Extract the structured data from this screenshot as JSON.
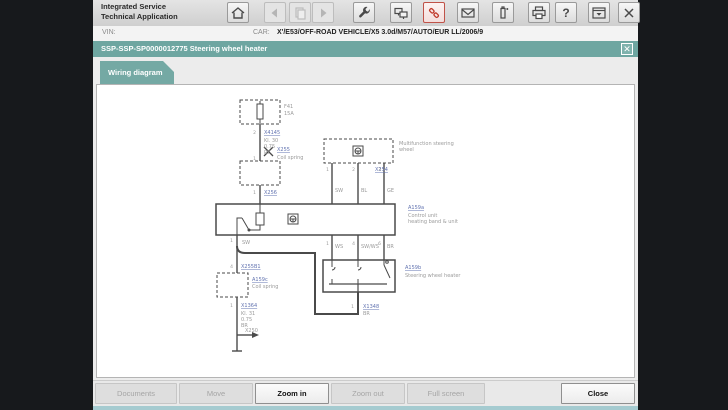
{
  "window": {
    "title_line1": "Integrated Service",
    "title_line2": "Technical Application"
  },
  "toolbar": {
    "icons": [
      "home",
      "back",
      "document",
      "forward",
      "workshop-tools",
      "terminal-mode",
      "vehicle-connection",
      "messages",
      "measuring-devices",
      "print",
      "help",
      "minimize-window",
      "close-window"
    ],
    "help_glyph": "?",
    "close_glyph": "✕"
  },
  "vin_bar": {
    "vin_label": "VIN:",
    "car_label": "CAR:",
    "vehicle": "X'/E53/OFF-ROAD VEHICLE/X5 3.0d/M57/AUTO/EUR LL/2006/9"
  },
  "doc_header": {
    "title": "SSP-SSP-SP0000012775 Steering wheel heater",
    "close_glyph": "✕"
  },
  "tabs": [
    {
      "label": "Wiring diagram",
      "active": true
    }
  ],
  "diagram": {
    "fuse_ref": "F41",
    "fuse_amp": "15A",
    "pin_a": "2",
    "conn_a": "X4145",
    "wire_a": [
      "Kl. 30",
      "0.75",
      "RT"
    ],
    "pin_b": "1",
    "conn_b": "X255",
    "cut_label": "Coil spring",
    "pin_e": "1",
    "conn_e": "X256",
    "mfl_label1": "Multifunction steering",
    "mfl_label2": "wheel",
    "mfl_conn": "X254",
    "mfl_pins": [
      "1",
      "2",
      "3"
    ],
    "top_wire_colors": [
      "SW",
      "BL",
      "GE"
    ],
    "ctrl_ref": "A159a",
    "ctrl_label1": "Control unit",
    "ctrl_label2": "heating band & unit",
    "main_pin": "1",
    "wire_sw": "SW",
    "pin_c": "4",
    "conn_c": "X255B1",
    "spring_ref": "A159c",
    "spring_label": "Coil spring",
    "pin_d": "1",
    "conn_d": "X1364",
    "wire_b": [
      "Kl. 31",
      "0.75",
      "BR"
    ],
    "ground_point": "X250",
    "mid_pins": [
      "1",
      "4",
      "6"
    ],
    "mid_wire_colors": [
      "WS",
      "SW/WS",
      "BR"
    ],
    "heater_ref": "A159b",
    "heater_label": "Steering wheel heater",
    "loop_pin": "1",
    "loop_conn": "X1348",
    "loop_color": "BR"
  },
  "footer": {
    "buttons": [
      {
        "label": "Documents",
        "enabled": false
      },
      {
        "label": "Move",
        "enabled": false
      },
      {
        "label": "Zoom in",
        "enabled": true
      },
      {
        "label": "Zoom out",
        "enabled": false
      },
      {
        "label": "Full screen",
        "enabled": false
      },
      {
        "label": "Close",
        "enabled": true
      }
    ]
  },
  "colors": {
    "teal": "#6ea6a1",
    "tab_teal": "#74a9a4",
    "accent_red": "#c0392b",
    "link_blue": "#6273b0",
    "side_bar_dark": "#17191c"
  }
}
